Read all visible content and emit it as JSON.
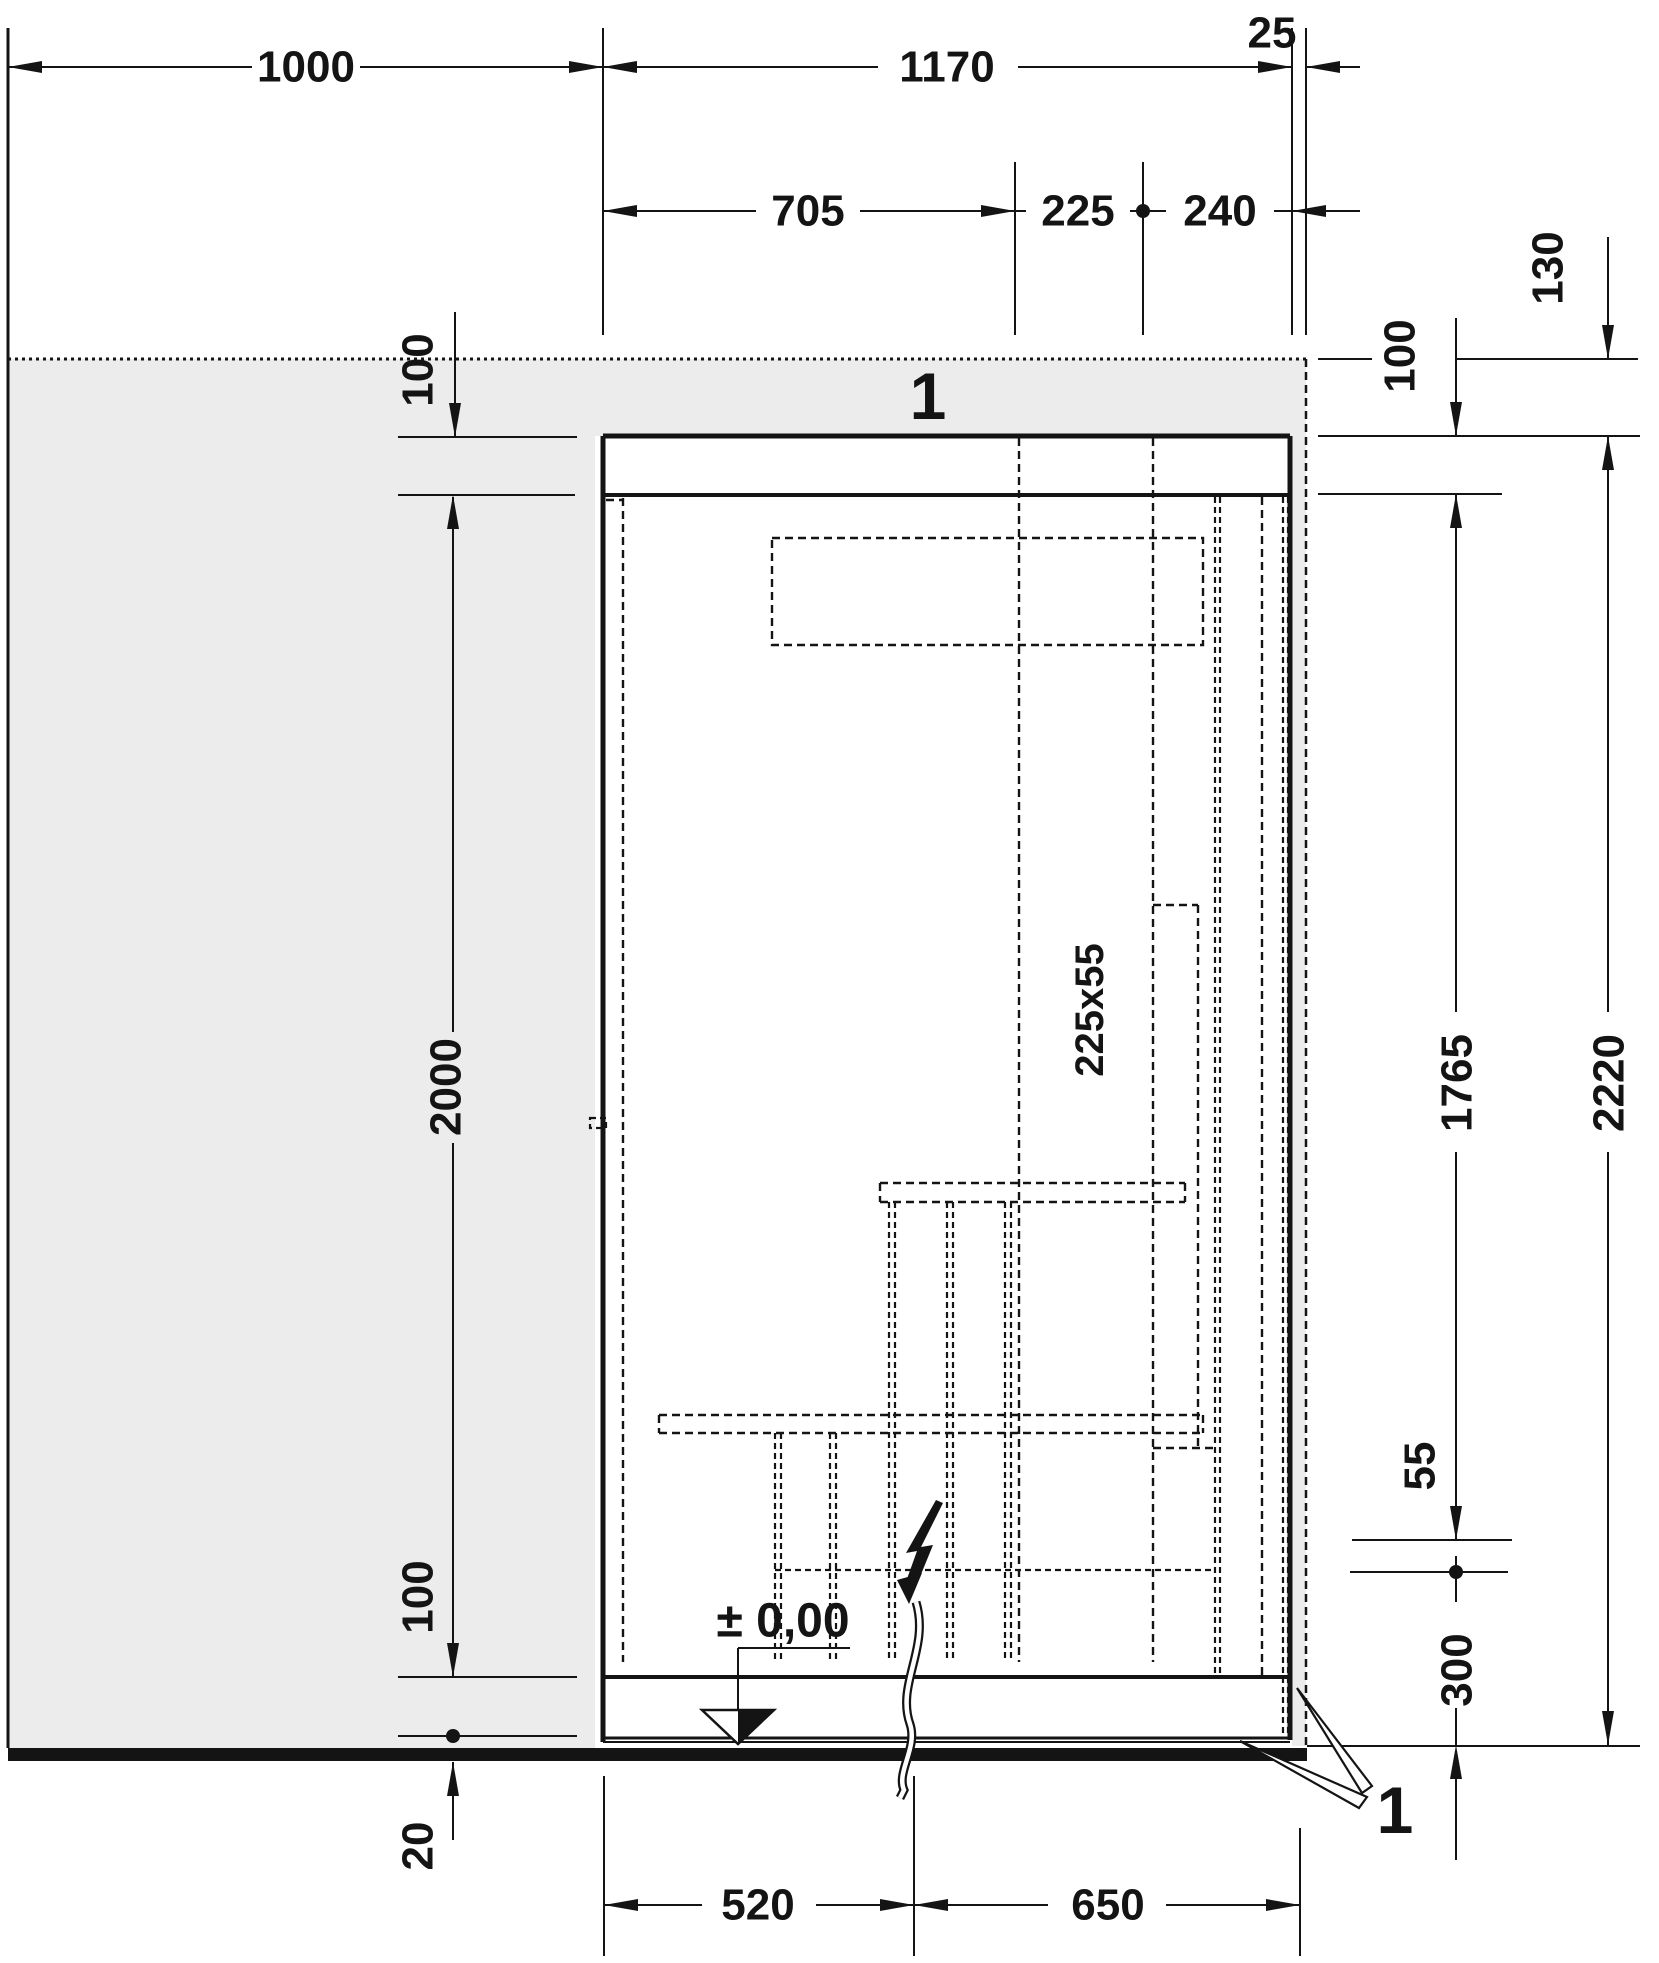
{
  "drawing_type": "technical installation drawing (front elevation with dimensions)",
  "colors": {
    "background": "#ffffff",
    "line": "#141414",
    "wall_fill": "#ececec"
  },
  "dims": {
    "top": {
      "w1000": "1000",
      "w1170": "1170",
      "w25": "25",
      "w705": "705",
      "w225": "225",
      "w240": "240"
    },
    "left": {
      "h100_top": "100",
      "h2000": "2000",
      "h100_bottom": "100",
      "h20": "20"
    },
    "right": {
      "h130": "130",
      "h100": "100",
      "h1765": "1765",
      "h2220": "2220",
      "h55": "55",
      "h300": "300"
    },
    "bottom": {
      "w520": "520",
      "w650": "650"
    }
  },
  "labels": {
    "section_marker_top": "1",
    "section_marker_bottom": "1",
    "duct_size": "225x55",
    "floor_level": "± 0,00"
  }
}
